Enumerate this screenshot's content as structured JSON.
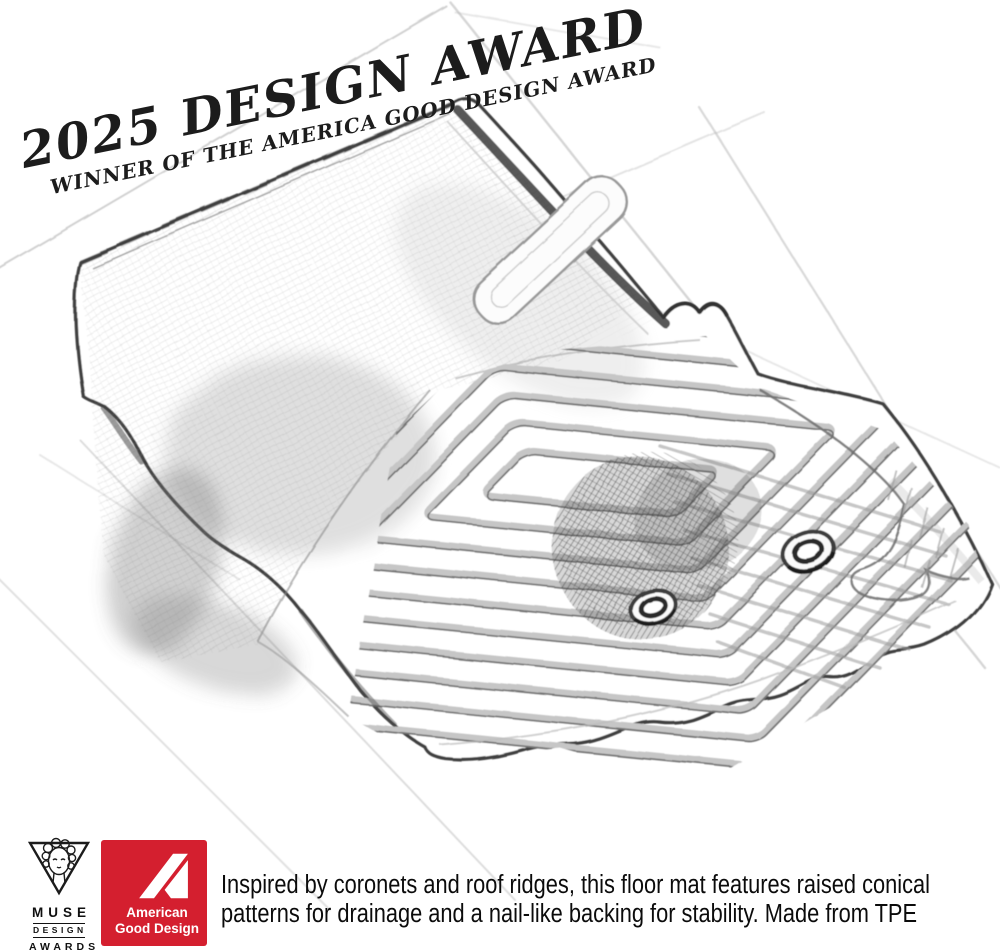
{
  "award_overlay": {
    "title": "2025 DESIGN AWARD",
    "subtitle": "WINNER OF THE AMERICA GOOD DESIGN AWARD"
  },
  "illustration": {
    "alt": "Pencil sketch of a vehicle floor mat with nested chevron ridge pattern, raised rear wall, two oval grommet holes and scalloped edge, drawn over a faint perspective grid"
  },
  "footer": {
    "muse_award": {
      "name": "MUSE",
      "line2": "DESIGN",
      "line3": "AWARDS"
    },
    "agd_award": {
      "line1": "American",
      "line2": "Good Design",
      "background_color": "#d41f2f",
      "text_color": "#ffffff"
    },
    "description": {
      "line1": "Inspired by coronets and roof ridges, this floor mat features raised conical",
      "line2": "patterns for drainage and a nail-like backing for stability. Made from TPE"
    }
  }
}
